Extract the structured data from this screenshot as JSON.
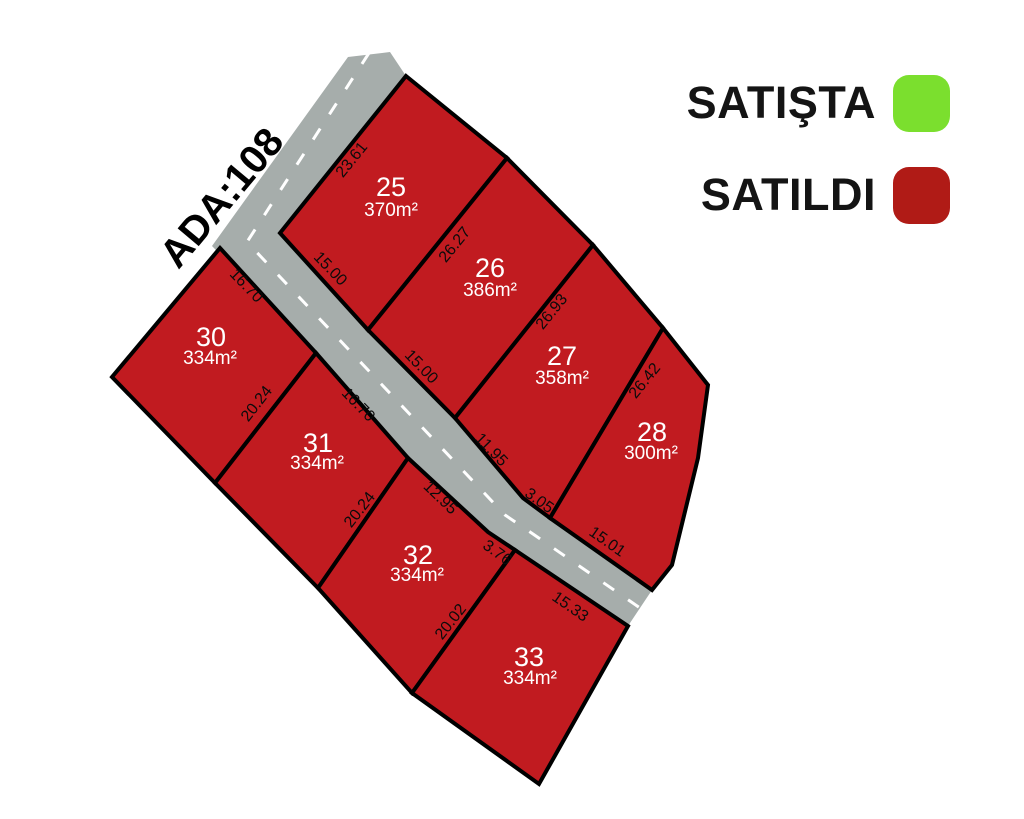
{
  "legend": {
    "items": [
      {
        "label": "SATIŞTA",
        "status": "for_sale",
        "color": "#7bdf2e"
      },
      {
        "label": "SATILDI",
        "status": "sold",
        "color": "#b01b16"
      }
    ]
  },
  "block_label": {
    "text": "ADA:108",
    "transform": "translate(222 198) rotate(-50)"
  },
  "map": {
    "plot_fill": "#c11b20",
    "outline_color": "#000000",
    "road": {
      "color": "#a6adab",
      "points": "348,57 390,52 406,76 280,233 368,330 455,418 523,498 550,518 652,590 628,626 515,550 488,532 408,458 316,353 212,246",
      "centerline": "369,53 247,242 505,515 533,534 640,608",
      "centerline_color": "#ffffff"
    },
    "plots": [
      {
        "number": "25",
        "area": "370m²",
        "status": "SATILDI",
        "points": "406,76 507,158 368,330 280,233",
        "num_transform": "translate(391 196)",
        "area_transform": "translate(391 216)"
      },
      {
        "number": "26",
        "area": "386m²",
        "status": "SATILDI",
        "points": "507,158 593,245 455,418 368,330",
        "num_transform": "translate(490 277)",
        "area_transform": "translate(490 296)"
      },
      {
        "number": "27",
        "area": "358m²",
        "status": "SATILDI",
        "points": "593,245 663,328 550,518 523,498 455,418",
        "num_transform": "translate(562 365)",
        "area_transform": "translate(562 384)"
      },
      {
        "number": "28",
        "area": "300m²",
        "status": "SATILDI",
        "points": "663,328 708,385 698,458 672,565 652,590 550,518",
        "num_transform": "translate(652 441)",
        "area_transform": "translate(651 459)"
      },
      {
        "number": "30",
        "area": "334m²",
        "status": "SATILDI",
        "points": "220,248 316,353 215,483 112,377",
        "num_transform": "translate(211 346)",
        "area_transform": "translate(210 364)"
      },
      {
        "number": "31",
        "area": "334m²",
        "status": "SATILDI",
        "points": "316,353 408,458 318,588 215,483",
        "num_transform": "translate(318 452)",
        "area_transform": "translate(317 469)"
      },
      {
        "number": "32",
        "area": "334m²",
        "status": "SATILDI",
        "points": "408,458 488,532 515,550 412,693 318,588",
        "num_transform": "translate(418 564)",
        "area_transform": "translate(417 581)"
      },
      {
        "number": "33",
        "area": "334m²",
        "status": "SATILDI",
        "points": "515,550 628,626 539,784 412,693",
        "num_transform": "translate(529 666)",
        "area_transform": "translate(530 684)"
      }
    ],
    "dimensions": [
      {
        "text": "23.61",
        "transform": "translate(352 160) rotate(-51)"
      },
      {
        "text": "26.27",
        "transform": "translate(455 245) rotate(-51)"
      },
      {
        "text": "26.93",
        "transform": "translate(552 312) rotate(-51)"
      },
      {
        "text": "26.42",
        "transform": "translate(645 381) rotate(-51)"
      },
      {
        "text": "15.00",
        "transform": "translate(330 269) rotate(46)"
      },
      {
        "text": "15.00",
        "transform": "translate(421 367) rotate(46)"
      },
      {
        "text": "11.95",
        "transform": "translate(491 450) rotate(46)"
      },
      {
        "text": "3.05",
        "transform": "translate(539 501) rotate(36)"
      },
      {
        "text": "15.01",
        "transform": "translate(607 542) rotate(35)"
      },
      {
        "text": "16.70",
        "transform": "translate(246 286) rotate(46)"
      },
      {
        "text": "16.70",
        "transform": "translate(358 405) rotate(46)"
      },
      {
        "text": "12.95",
        "transform": "translate(440 498) rotate(44)"
      },
      {
        "text": "3.76",
        "transform": "translate(497 553) rotate(36)"
      },
      {
        "text": "15.33",
        "transform": "translate(570 607) rotate(35)"
      },
      {
        "text": "20.24",
        "transform": "translate(257 404) rotate(-52)"
      },
      {
        "text": "20.24",
        "transform": "translate(360 510) rotate(-52)"
      },
      {
        "text": "20.02",
        "transform": "translate(451 622) rotate(-52)"
      }
    ]
  }
}
